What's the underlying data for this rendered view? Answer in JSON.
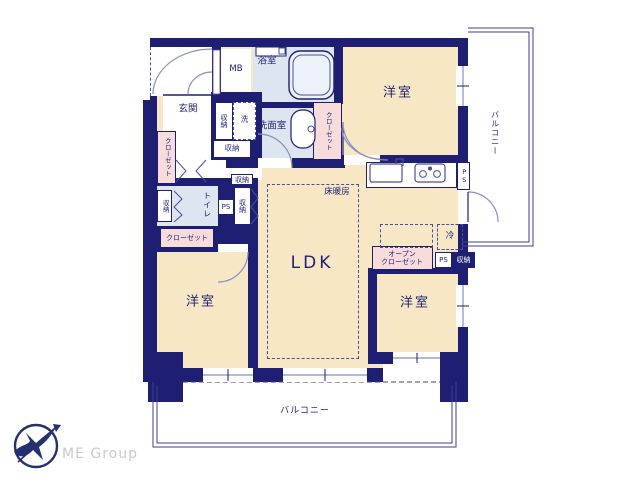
{
  "rooms": {
    "western_room": "洋室",
    "ldk": "LDK",
    "bathroom": "浴室",
    "washroom": "洗面室",
    "entrance": "玄関",
    "toilet": "トイレ",
    "meter_box": "MB"
  },
  "storage": {
    "closet": "クローゼット",
    "open_closet_line1": "オープン",
    "open_closet_line2": "クローゼット",
    "storage": "収納",
    "laundry": "洗"
  },
  "labels": {
    "floor_heating": "床暖房",
    "refrigerator": "冷",
    "pipe_space": "PS",
    "balcony": "バルコニー"
  },
  "colors": {
    "wall": "#1e1f72",
    "room": "#f7e7c5",
    "wet": "#dde5f1",
    "closet": "#f8dcdc",
    "text": "#1e2277"
  },
  "footer": {
    "logo_text": "ME Group"
  }
}
